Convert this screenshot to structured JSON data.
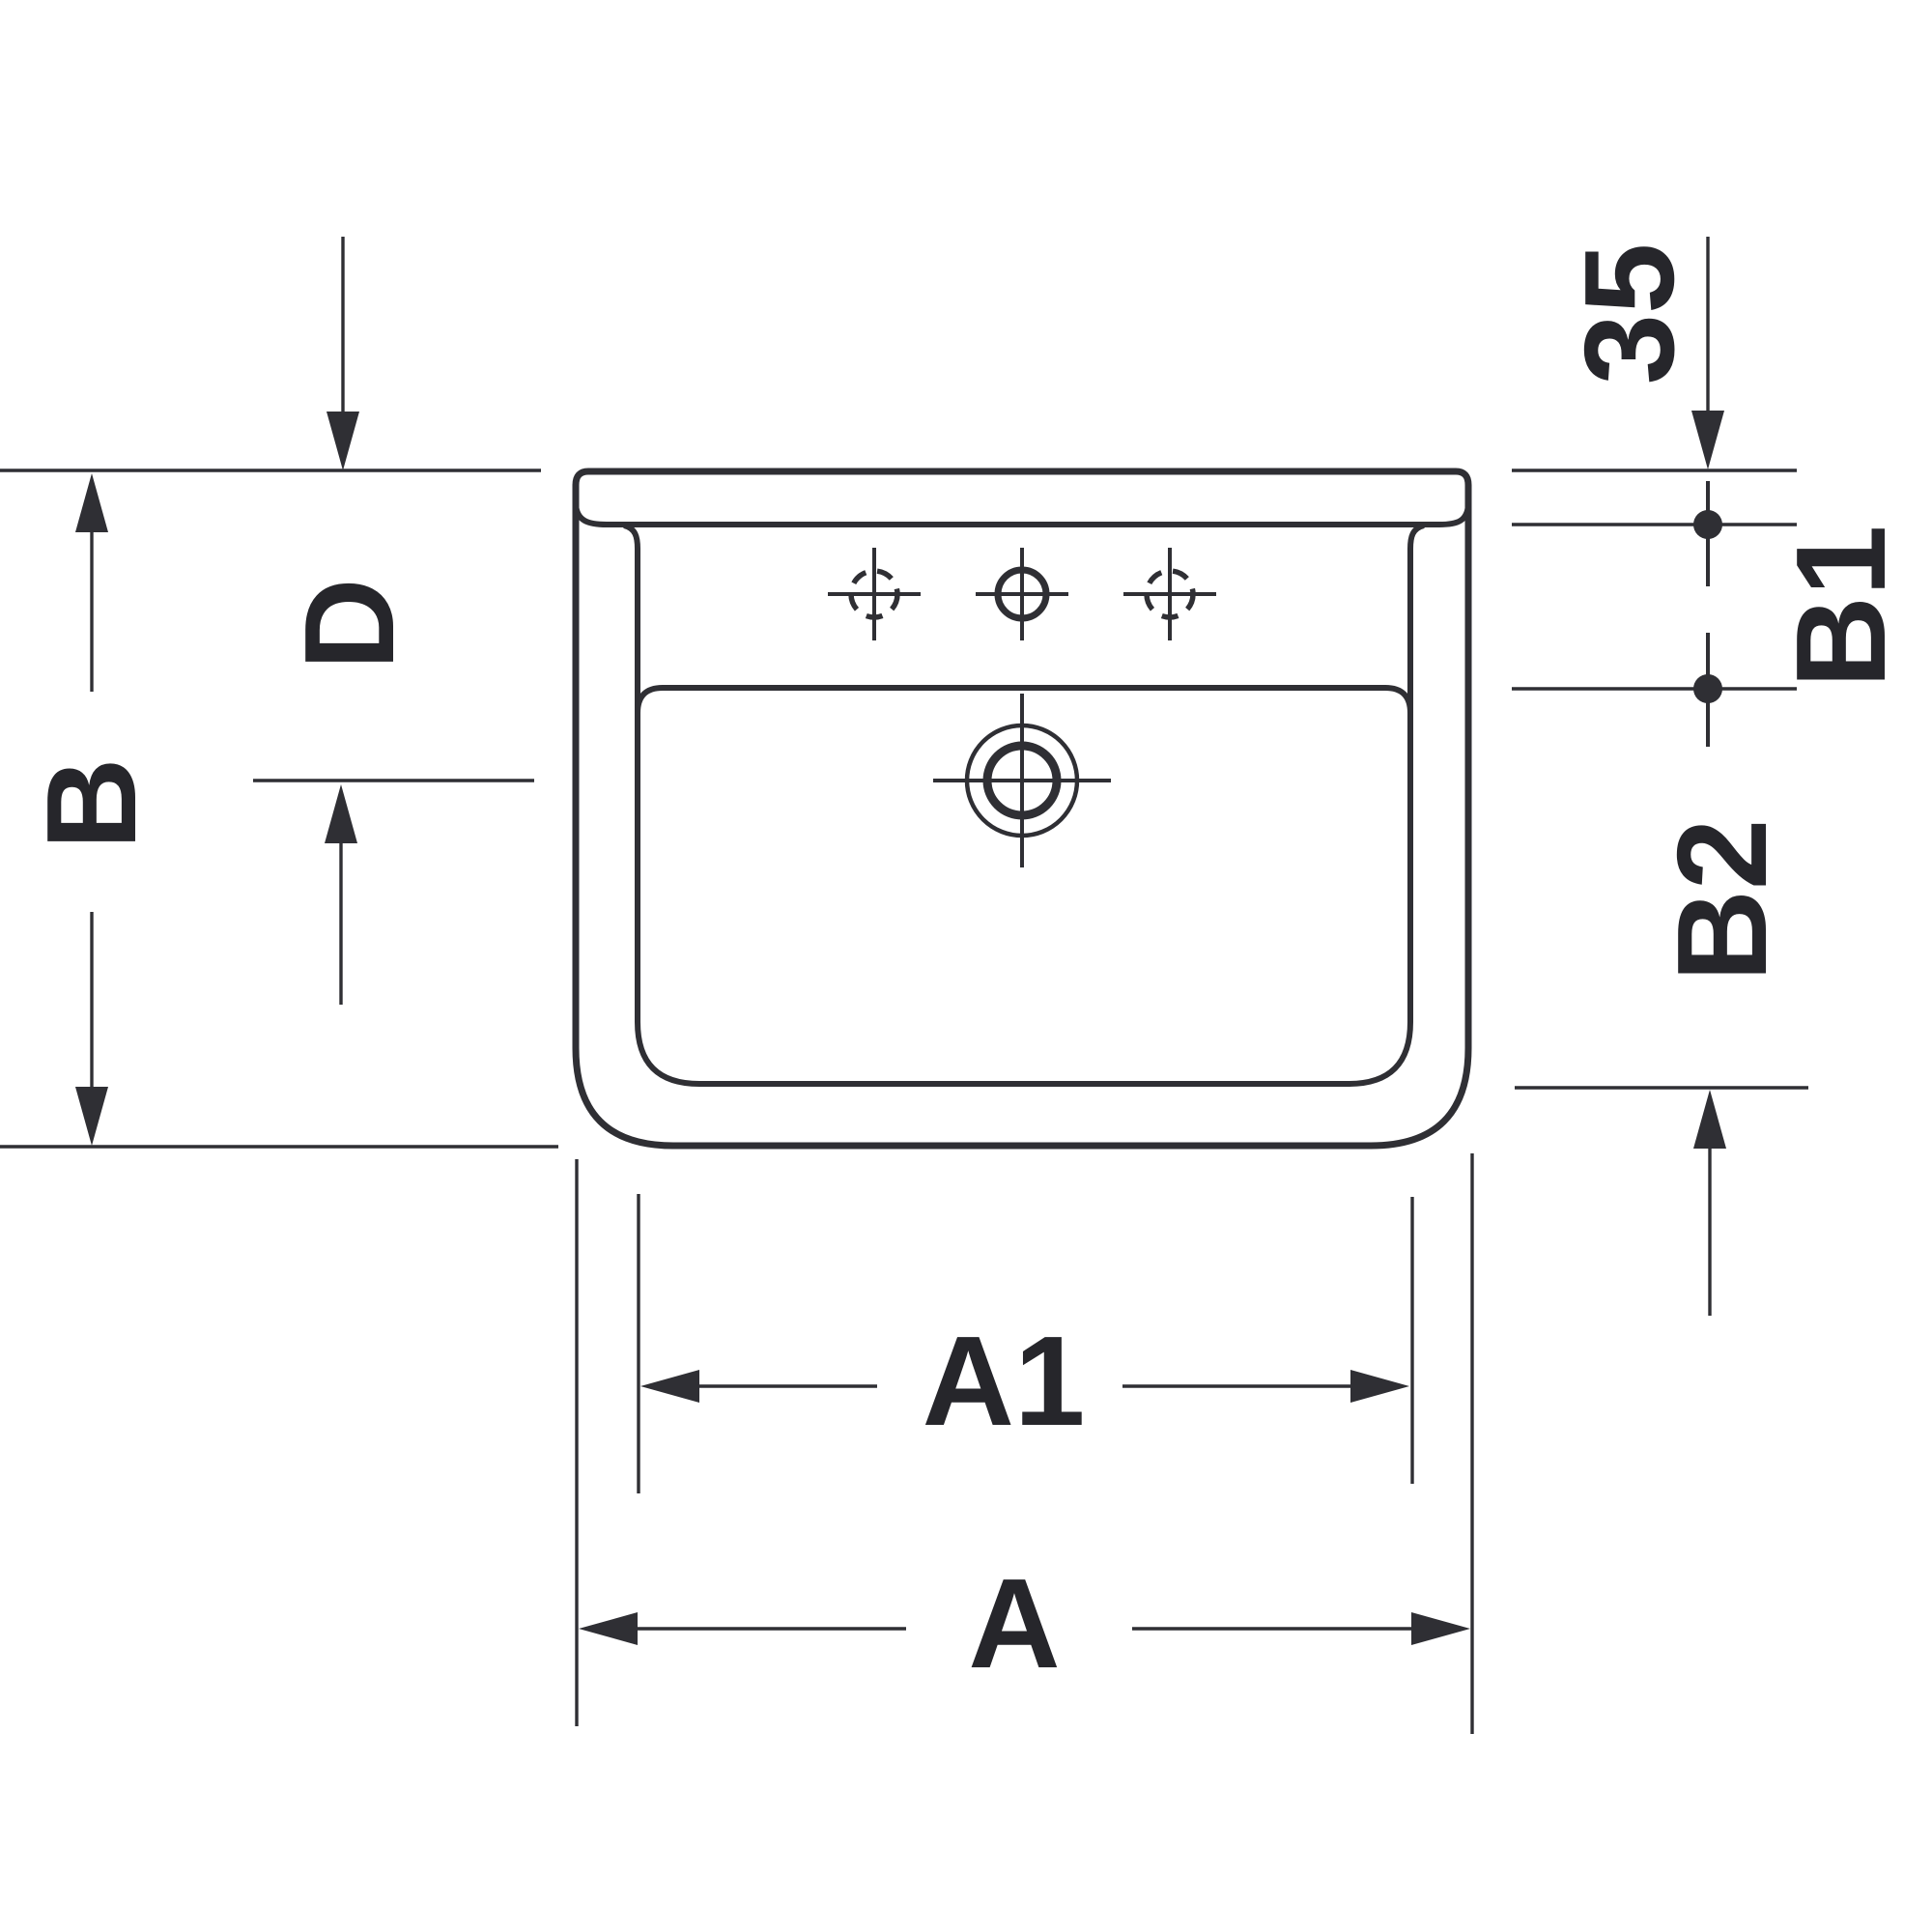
{
  "drawing": {
    "title": "Washbasin technical drawing, top view with dimension lines",
    "background_color": "#ffffff",
    "line_color": "#2f2f34",
    "text_color": "#26262b",
    "labels": {
      "a": "A",
      "a1": "A1",
      "b": "B",
      "b1": "B1",
      "b2": "B2",
      "d": "D",
      "offset_35": "35"
    }
  }
}
